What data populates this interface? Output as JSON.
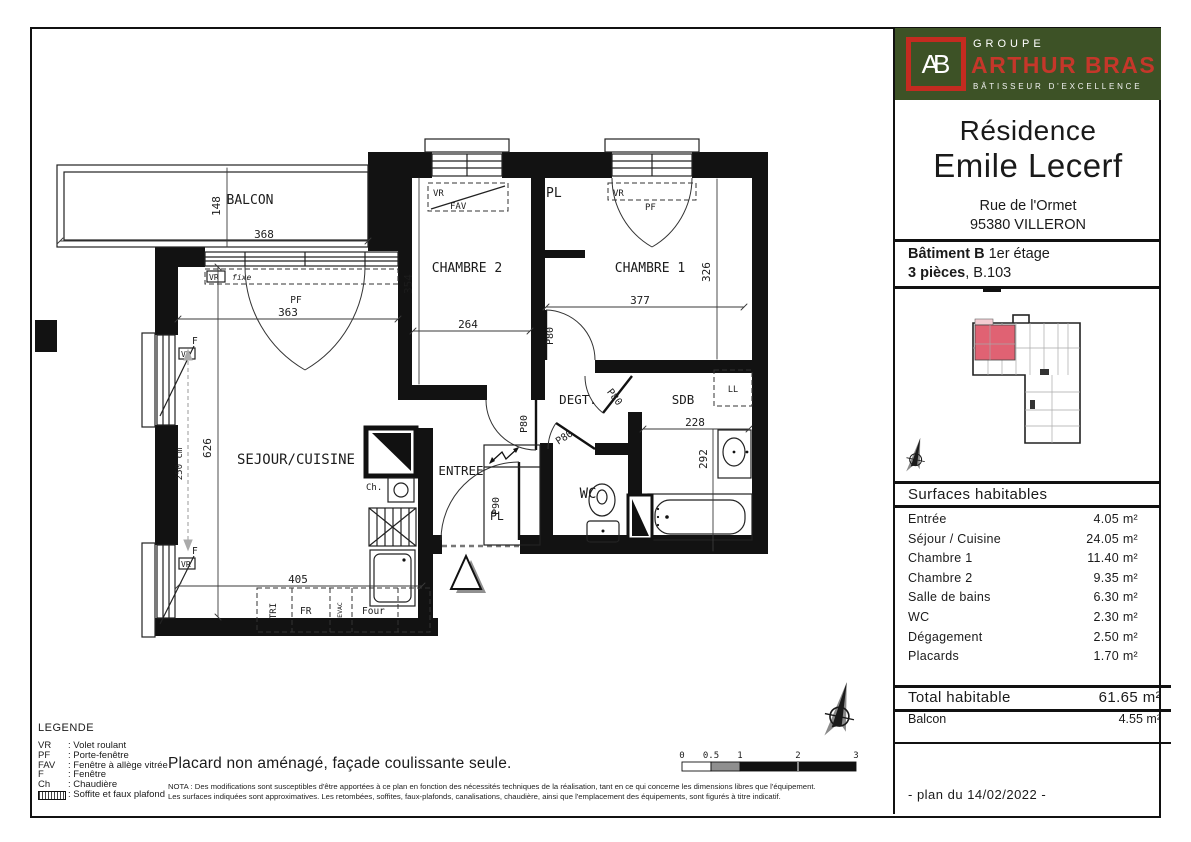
{
  "sidebar": {
    "logo": {
      "monogram": "AB",
      "groupe": "GROUPE",
      "brand": "ARTHUR BRAS",
      "tagline": "BÂTISSEUR D'EXCELLENCE"
    },
    "residence": {
      "line1": "Résidence",
      "line2": "Emile Lecerf",
      "address1": "Rue de l'Ormet",
      "address2": "95380 VILLERON"
    },
    "unit": {
      "batiment_bold": "Bâtiment B",
      "batiment_rest": " 1er étage",
      "pieces_bold": "3 pièces",
      "pieces_rest": ", B.103"
    },
    "surfaces": {
      "header": "Surfaces habitables",
      "rows": [
        {
          "label": "Entrée",
          "value": "4.05 m²"
        },
        {
          "label": "Séjour / Cuisine",
          "value": "24.05 m²"
        },
        {
          "label": "Chambre 1",
          "value": "11.40 m²"
        },
        {
          "label": "Chambre 2",
          "value": "9.35 m²"
        },
        {
          "label": "Salle de bains",
          "value": "6.30 m²"
        },
        {
          "label": "WC",
          "value": "2.30 m²"
        },
        {
          "label": "Dégagement",
          "value": "2.50 m²"
        },
        {
          "label": "Placards",
          "value": "1.70 m²"
        }
      ],
      "total_label": "Total habitable",
      "total_value": "61.65 m²",
      "balcon_label": "Balcon",
      "balcon_value": "4.55 m²"
    },
    "plan_date": "- plan du 14/02/2022 -"
  },
  "legend": {
    "title": "LEGENDE",
    "items": [
      {
        "abbr": "VR",
        "label": ": Volet roulant"
      },
      {
        "abbr": "PF",
        "label": ": Porte-fenêtre"
      },
      {
        "abbr": "FAV",
        "label": ": Fenêtre à allège vitrée"
      },
      {
        "abbr": "F",
        "label": ": Fenêtre"
      },
      {
        "abbr": "Ch",
        "label": ": Chaudière"
      }
    ],
    "soffite_label": ": Soffite et faux plafond"
  },
  "notes": {
    "placard": "Placard non aménagé, façade coulissante seule.",
    "nota_line1": "NOTA : Des modifications sont susceptibles d'être apportées à ce plan en fonction des nécessités techniques de la réalisation, tant en ce qui concerne les dimensions libres que l'équipement.",
    "nota_line2": "Les surfaces indiquées sont approximatives. Les retombées, soffites, faux-plafonds, canalisations, chaudière, ainsi que l'emplacement des équipements, sont figurés à titre indicatif."
  },
  "scalebar": {
    "ticks": [
      "0",
      "0.5",
      "1",
      "2",
      "3"
    ]
  },
  "plan": {
    "rooms": {
      "balcon": "BALCON",
      "chambre2": "CHAMBRE 2",
      "chambre1": "CHAMBRE 1",
      "sejour": "SEJOUR/CUISINE",
      "entree": "ENTREE",
      "wc": "WC",
      "degt": "DEGT.",
      "sdb": "SDB",
      "placard": "PL"
    },
    "dims": {
      "balcon_depth": "148",
      "balcon_width": "368",
      "sejour_window": "363",
      "sejour_height": "626",
      "sejour_width": "405",
      "chambre2_height": "354",
      "chambre2_width": "264",
      "chambre1_width": "377",
      "chambre1_height": "326",
      "sdb_width": "228",
      "sdb_height": "292",
      "west_wall": "250 cm"
    },
    "doors": {
      "p80": "P80",
      "p90": "P90"
    },
    "openings": {
      "vr": "VR",
      "fixe": "fixe",
      "fav": "FAV",
      "pf": "PF",
      "f": "F"
    },
    "equipment": {
      "tri": "TRI",
      "fr": "FR",
      "evac": "EVAC",
      "four": "Four",
      "ch": "Ch.",
      "ll": "LL"
    }
  },
  "colors": {
    "brand_green": "#3d5226",
    "brand_red": "#c32b20",
    "keyplan_highlight": "#e06273",
    "keyplan_balcony": "#f3ccd2"
  }
}
